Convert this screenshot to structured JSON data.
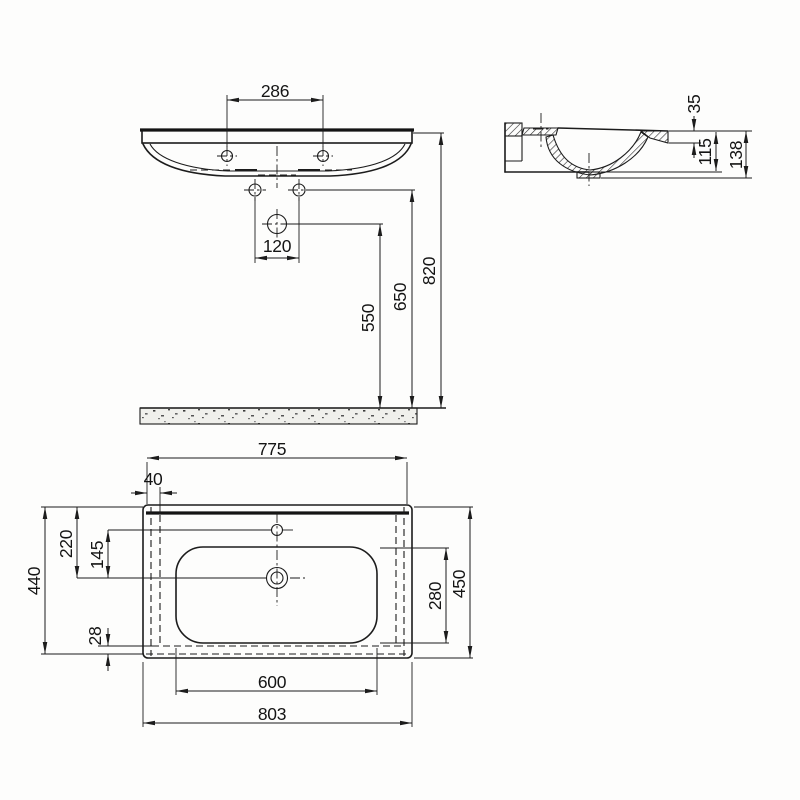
{
  "colors": {
    "line": "#1c1c1c",
    "background": "#fdfdfc",
    "floor_fill": "#f0f0ec"
  },
  "views": {
    "front": {
      "dims": {
        "tap_hole_spacing": "286",
        "fixing_hole_spacing": "120",
        "drain_height": "550",
        "fixing_hole_height": "650",
        "overall_height": "820"
      }
    },
    "side": {
      "dims": {
        "rim_thickness": "35",
        "bowl_depth": "115",
        "overall_depth": "138"
      }
    },
    "plan": {
      "dims": {
        "top_width": "775",
        "back_edge_offset": "40",
        "back_to_drain": "220",
        "tap_to_drain": "145",
        "overall_depth": "440",
        "front_lip": "28",
        "bowl_inner_depth": "280",
        "side_depth": "450",
        "bowl_inner_width": "600",
        "overall_width": "803"
      }
    }
  }
}
